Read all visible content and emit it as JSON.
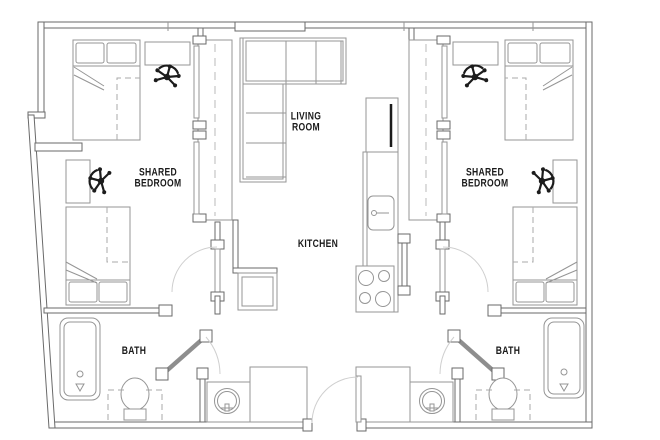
{
  "title": "Two-bedroom shared apartment floor plan",
  "colors": {
    "background": "#ffffff",
    "wall_line": "#6a6a6a",
    "fixture_line": "#959595",
    "dark_fixture": "#1c1c1c",
    "label_text": "#1a1a1a"
  },
  "rooms": {
    "living_room": {
      "line1": "LIVING",
      "line2": "ROOM"
    },
    "kitchen": {
      "label": "KITCHEN"
    },
    "bedroom_left": {
      "line1": "SHARED",
      "line2": "BEDROOM"
    },
    "bedroom_right": {
      "line1": "SHARED",
      "line2": "BEDROOM"
    },
    "bath_left": {
      "label": "BATH"
    },
    "bath_right": {
      "label": "BATH"
    }
  },
  "fixtures": {
    "sofa": "sofa-icon",
    "bed": "bed-icon",
    "pillow": "pillow-icon",
    "underbed_storage": "underbed-storage-dashed",
    "desk": "desk-icon",
    "office_chair": "office-chair-icon",
    "closet": "closet-icon",
    "closet_rod": "closet-rod-dashed-line",
    "refrigerator": "refrigerator-icon",
    "kitchen_sink": "kitchen-sink-icon",
    "stove": "stove-icon",
    "cabinet": "cabinet-icon",
    "bathtub": "bathtub-icon",
    "toilet": "toilet-icon",
    "vanity_sink": "vanity-sink-icon",
    "door": "door-swing-icon"
  }
}
